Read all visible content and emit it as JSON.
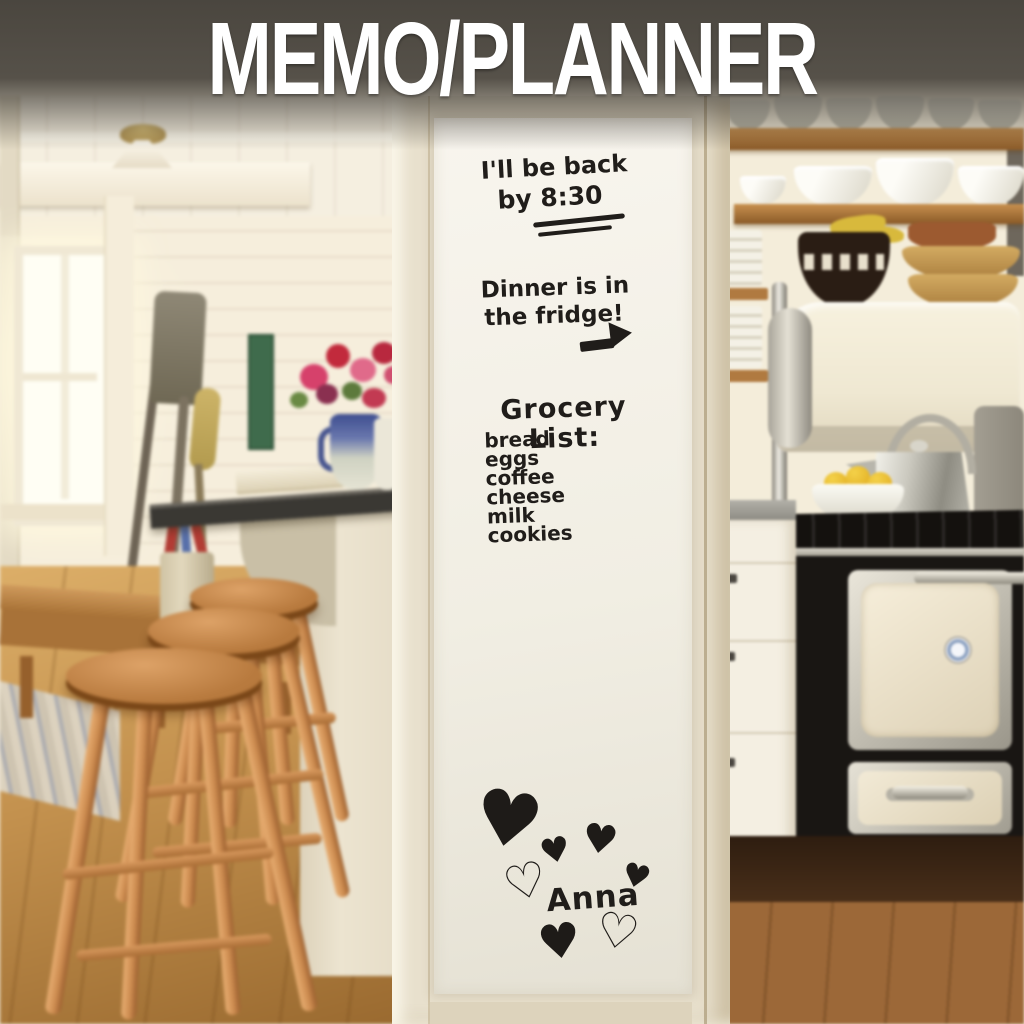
{
  "title": "MEMO/PLANNER",
  "memo_board": {
    "note_back": {
      "line1": "I'll be back",
      "line2": "by 8:30"
    },
    "note_dinner": {
      "line1": "Dinner is in",
      "line2": "the fridge!"
    },
    "grocery": {
      "heading": "Grocery List:",
      "items": [
        "bread",
        "eggs",
        "coffee",
        "cheese",
        "milk",
        "cookies"
      ]
    },
    "signature": "Anna"
  },
  "icons": {
    "heart_filled": "♥",
    "heart_outline": "♡"
  },
  "colors": {
    "banner_overlay": "#38342e",
    "title_text": "#ffffff",
    "marker_ink": "#201d1a",
    "memo_sheet_white": "#f4f1e8",
    "pillar_cream": "#e8e0cd",
    "stool_wood": "#c9894d",
    "stove_black": "#191613",
    "jar_blue": "#4e6cb2",
    "flower_pink": "#d4426a",
    "lemon_yellow": "#e9c237"
  }
}
